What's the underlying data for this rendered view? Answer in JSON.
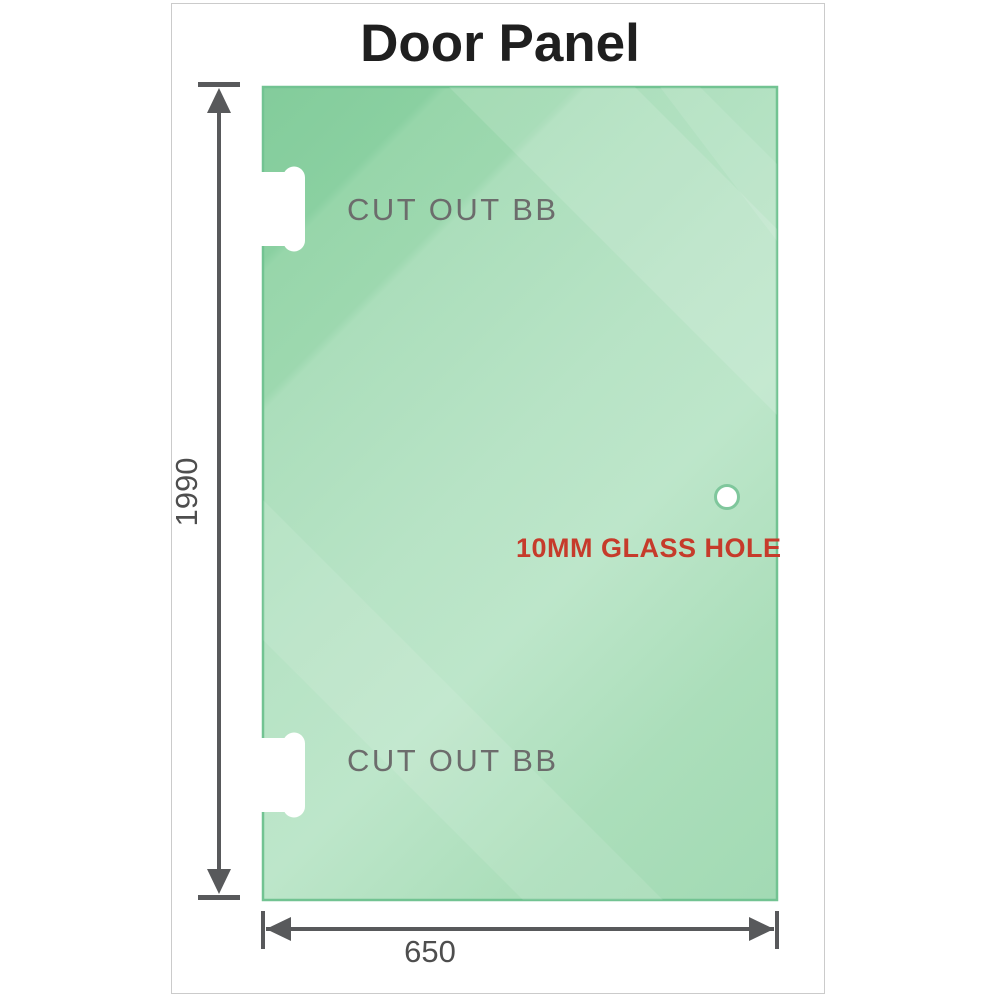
{
  "title": "Door Panel",
  "panel": {
    "cutouts": [
      {
        "label": "CUT OUT BB"
      },
      {
        "label": "CUT OUT BB"
      }
    ],
    "hole_label": "10MM GLASS HOLE"
  },
  "dimensions": {
    "height": "1990",
    "width": "650"
  },
  "colors": {
    "glass_green_dark": "#83cc9b",
    "glass_green_light": "#bde6ca",
    "glass_edge": "#72c392",
    "dimension_line": "#58595b",
    "dimension_text": "#4e4e4e",
    "hole_text_red": "#c63b2b",
    "cutout_text_gray": "#6c6c6c",
    "title_text": "#1f1f1f",
    "frame_border": "#cbcbcb"
  }
}
